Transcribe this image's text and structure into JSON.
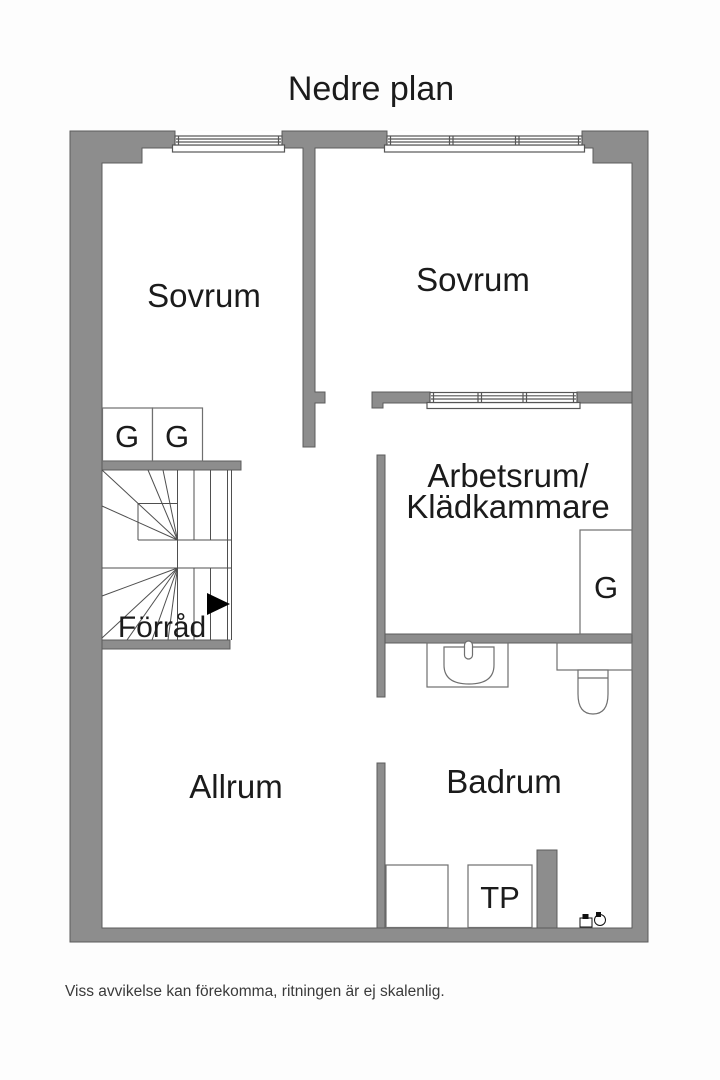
{
  "title": "Nedre plan",
  "footer": {
    "disclaimer": "Viss avvikelse kan förekomma, ritningen är ej skalenlig."
  },
  "rooms": {
    "sovrum_left": {
      "label": "Sovrum"
    },
    "sovrum_right": {
      "label": "Sovrum"
    },
    "arbetsrum": {
      "label_line1": "Arbetsrum/",
      "label_line2": "Klädkammare"
    },
    "forrad": {
      "label": "Förråd"
    },
    "allrum": {
      "label": "Allrum"
    },
    "badrum": {
      "label": "Badrum"
    }
  },
  "fixtures": {
    "wardrobe_1": {
      "label": "G"
    },
    "wardrobe_2": {
      "label": "G"
    },
    "wardrobe_3": {
      "label": "G"
    },
    "dryer_tower": {
      "label": "TP"
    }
  },
  "colors": {
    "wall": "#8d8d8d",
    "wall_outline": "#5c5c5c",
    "stair_line": "#4f4f4f",
    "fixture_line": "#6f6f6f",
    "window_line": "#565656",
    "text": "#1b1b1b",
    "floor": "#ffffff",
    "background": "#fdfdfd",
    "arrow": "#000000"
  }
}
